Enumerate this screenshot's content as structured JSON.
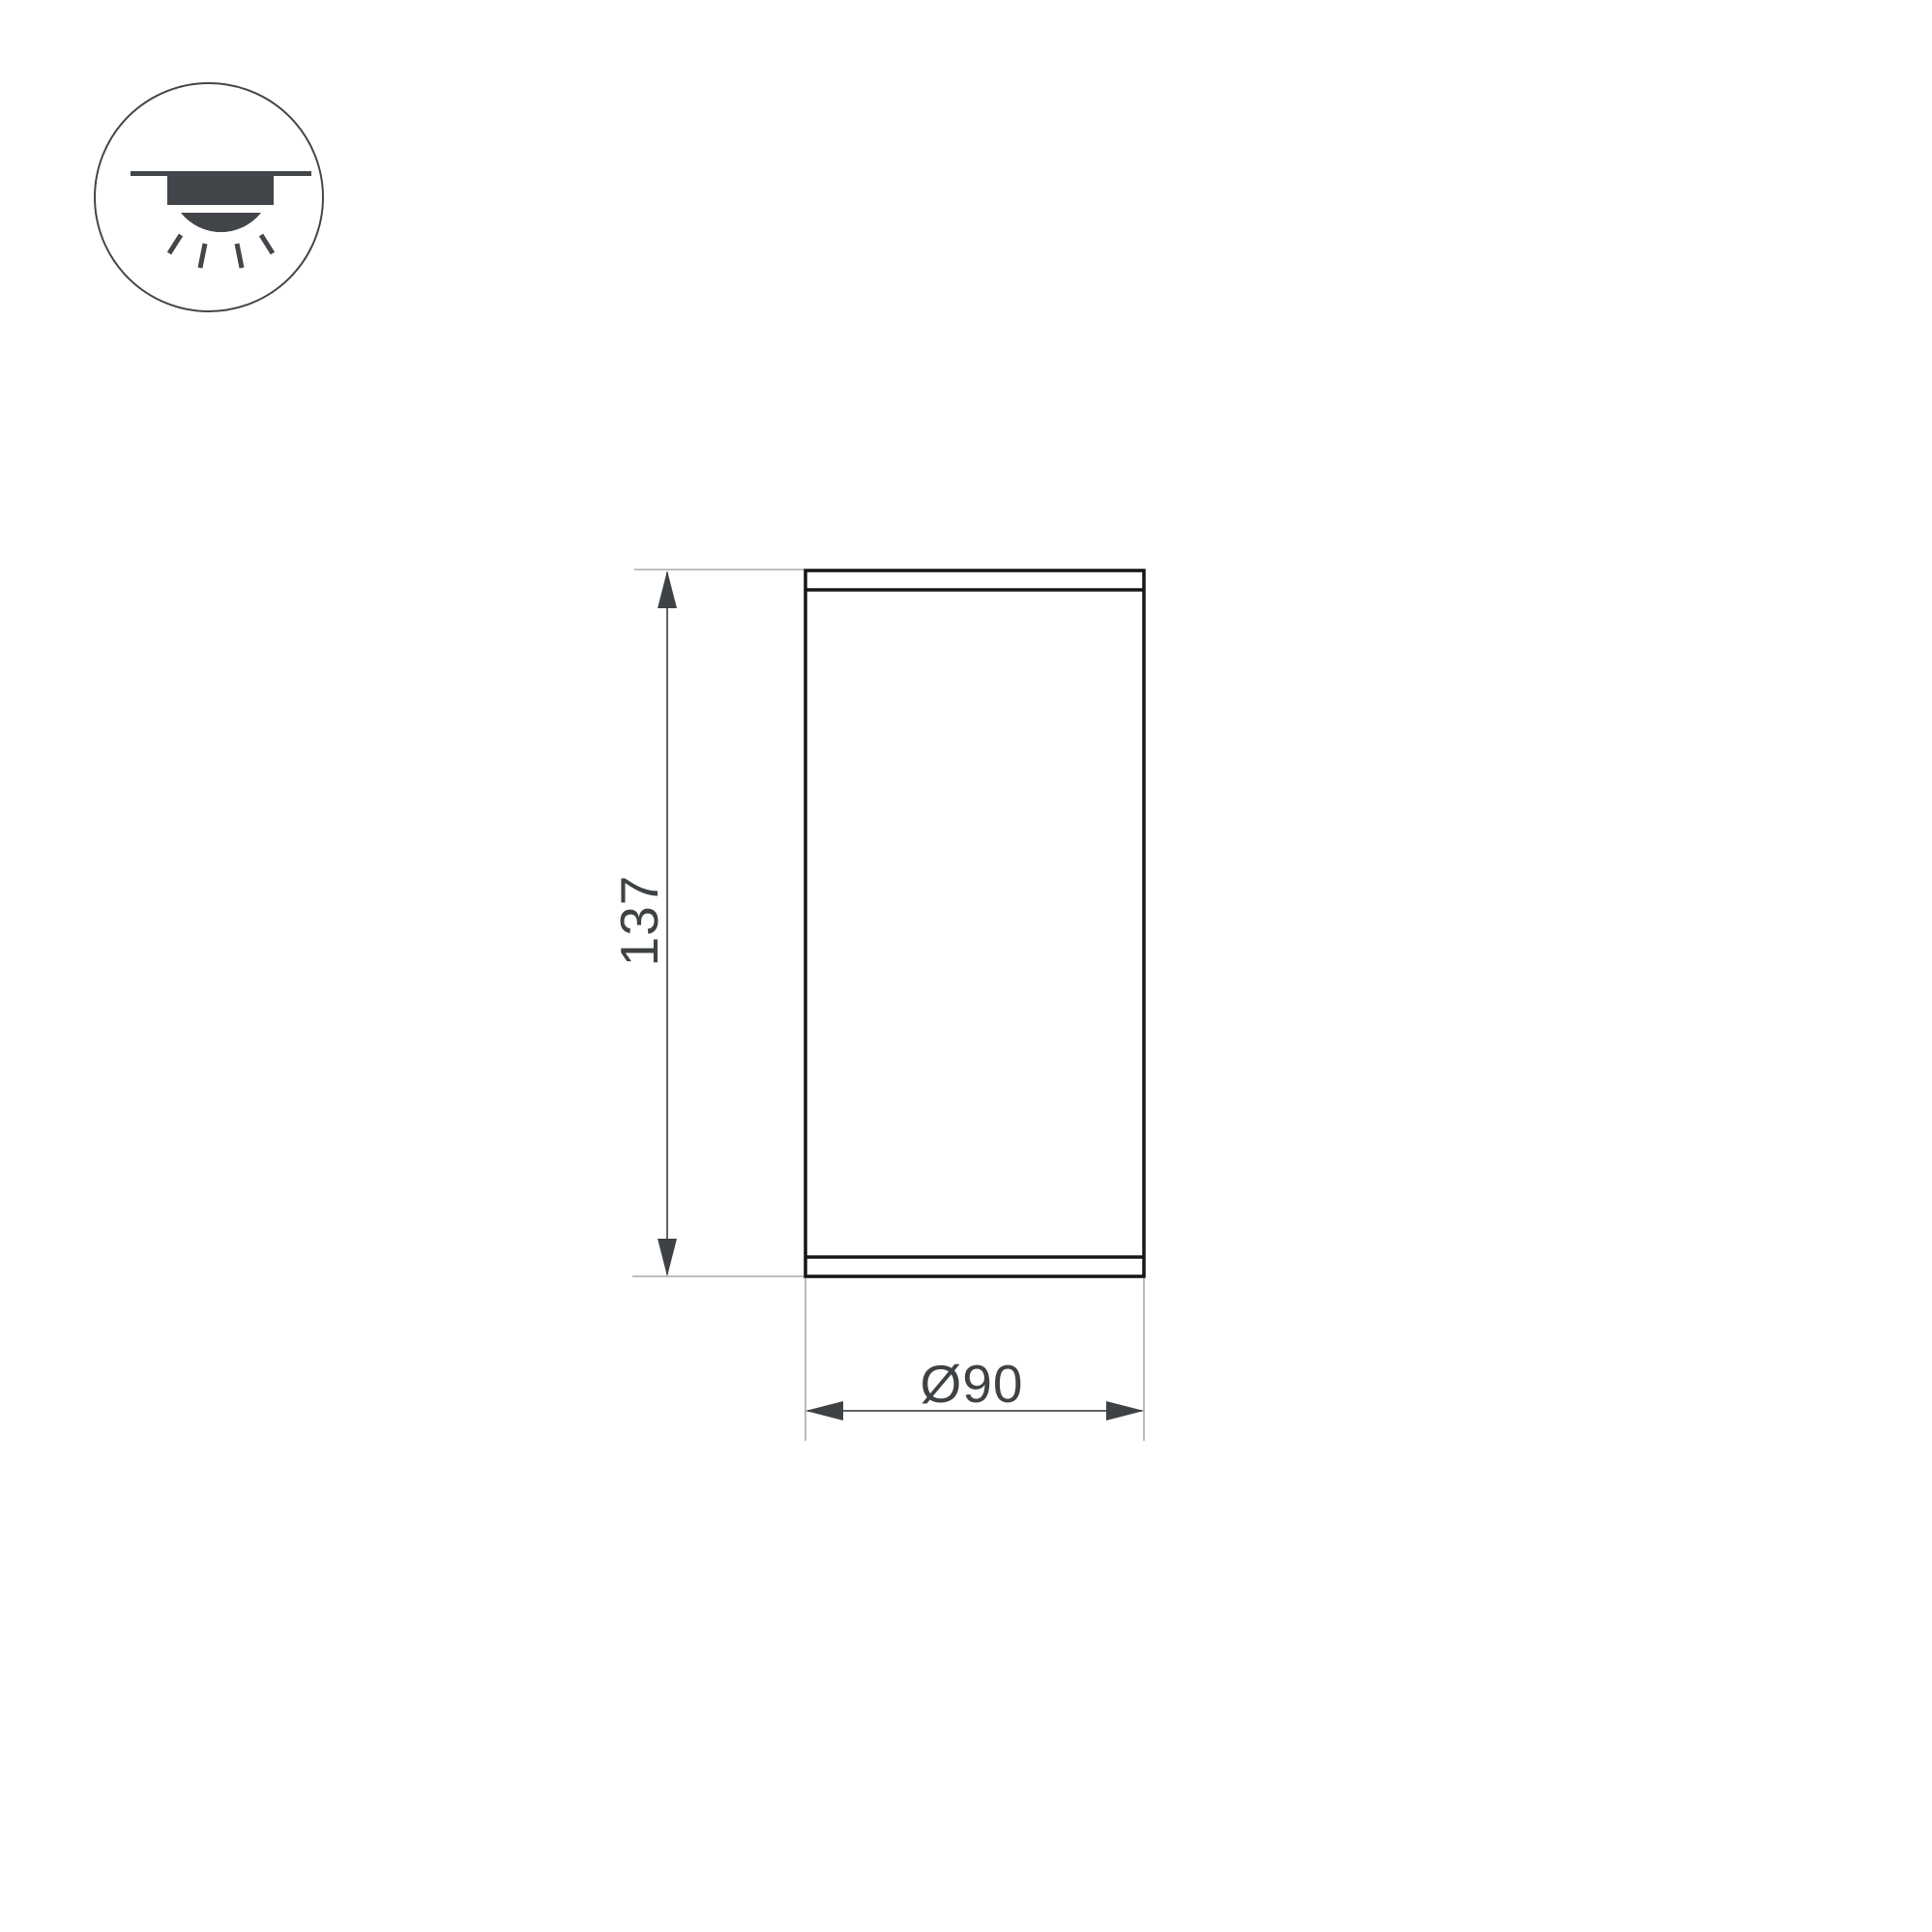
{
  "colors": {
    "background": "#ffffff",
    "outline": "#161616",
    "dimension": "#5f6265",
    "extension": "#a8aaac",
    "arrow": "#3e4245",
    "text": "#3e4245",
    "icon": "#42464a"
  },
  "icons": {
    "mount_type": "surface-mounted-ceiling-downlight-icon"
  },
  "dimensions": {
    "height": "137",
    "diameter": "Ø90"
  }
}
